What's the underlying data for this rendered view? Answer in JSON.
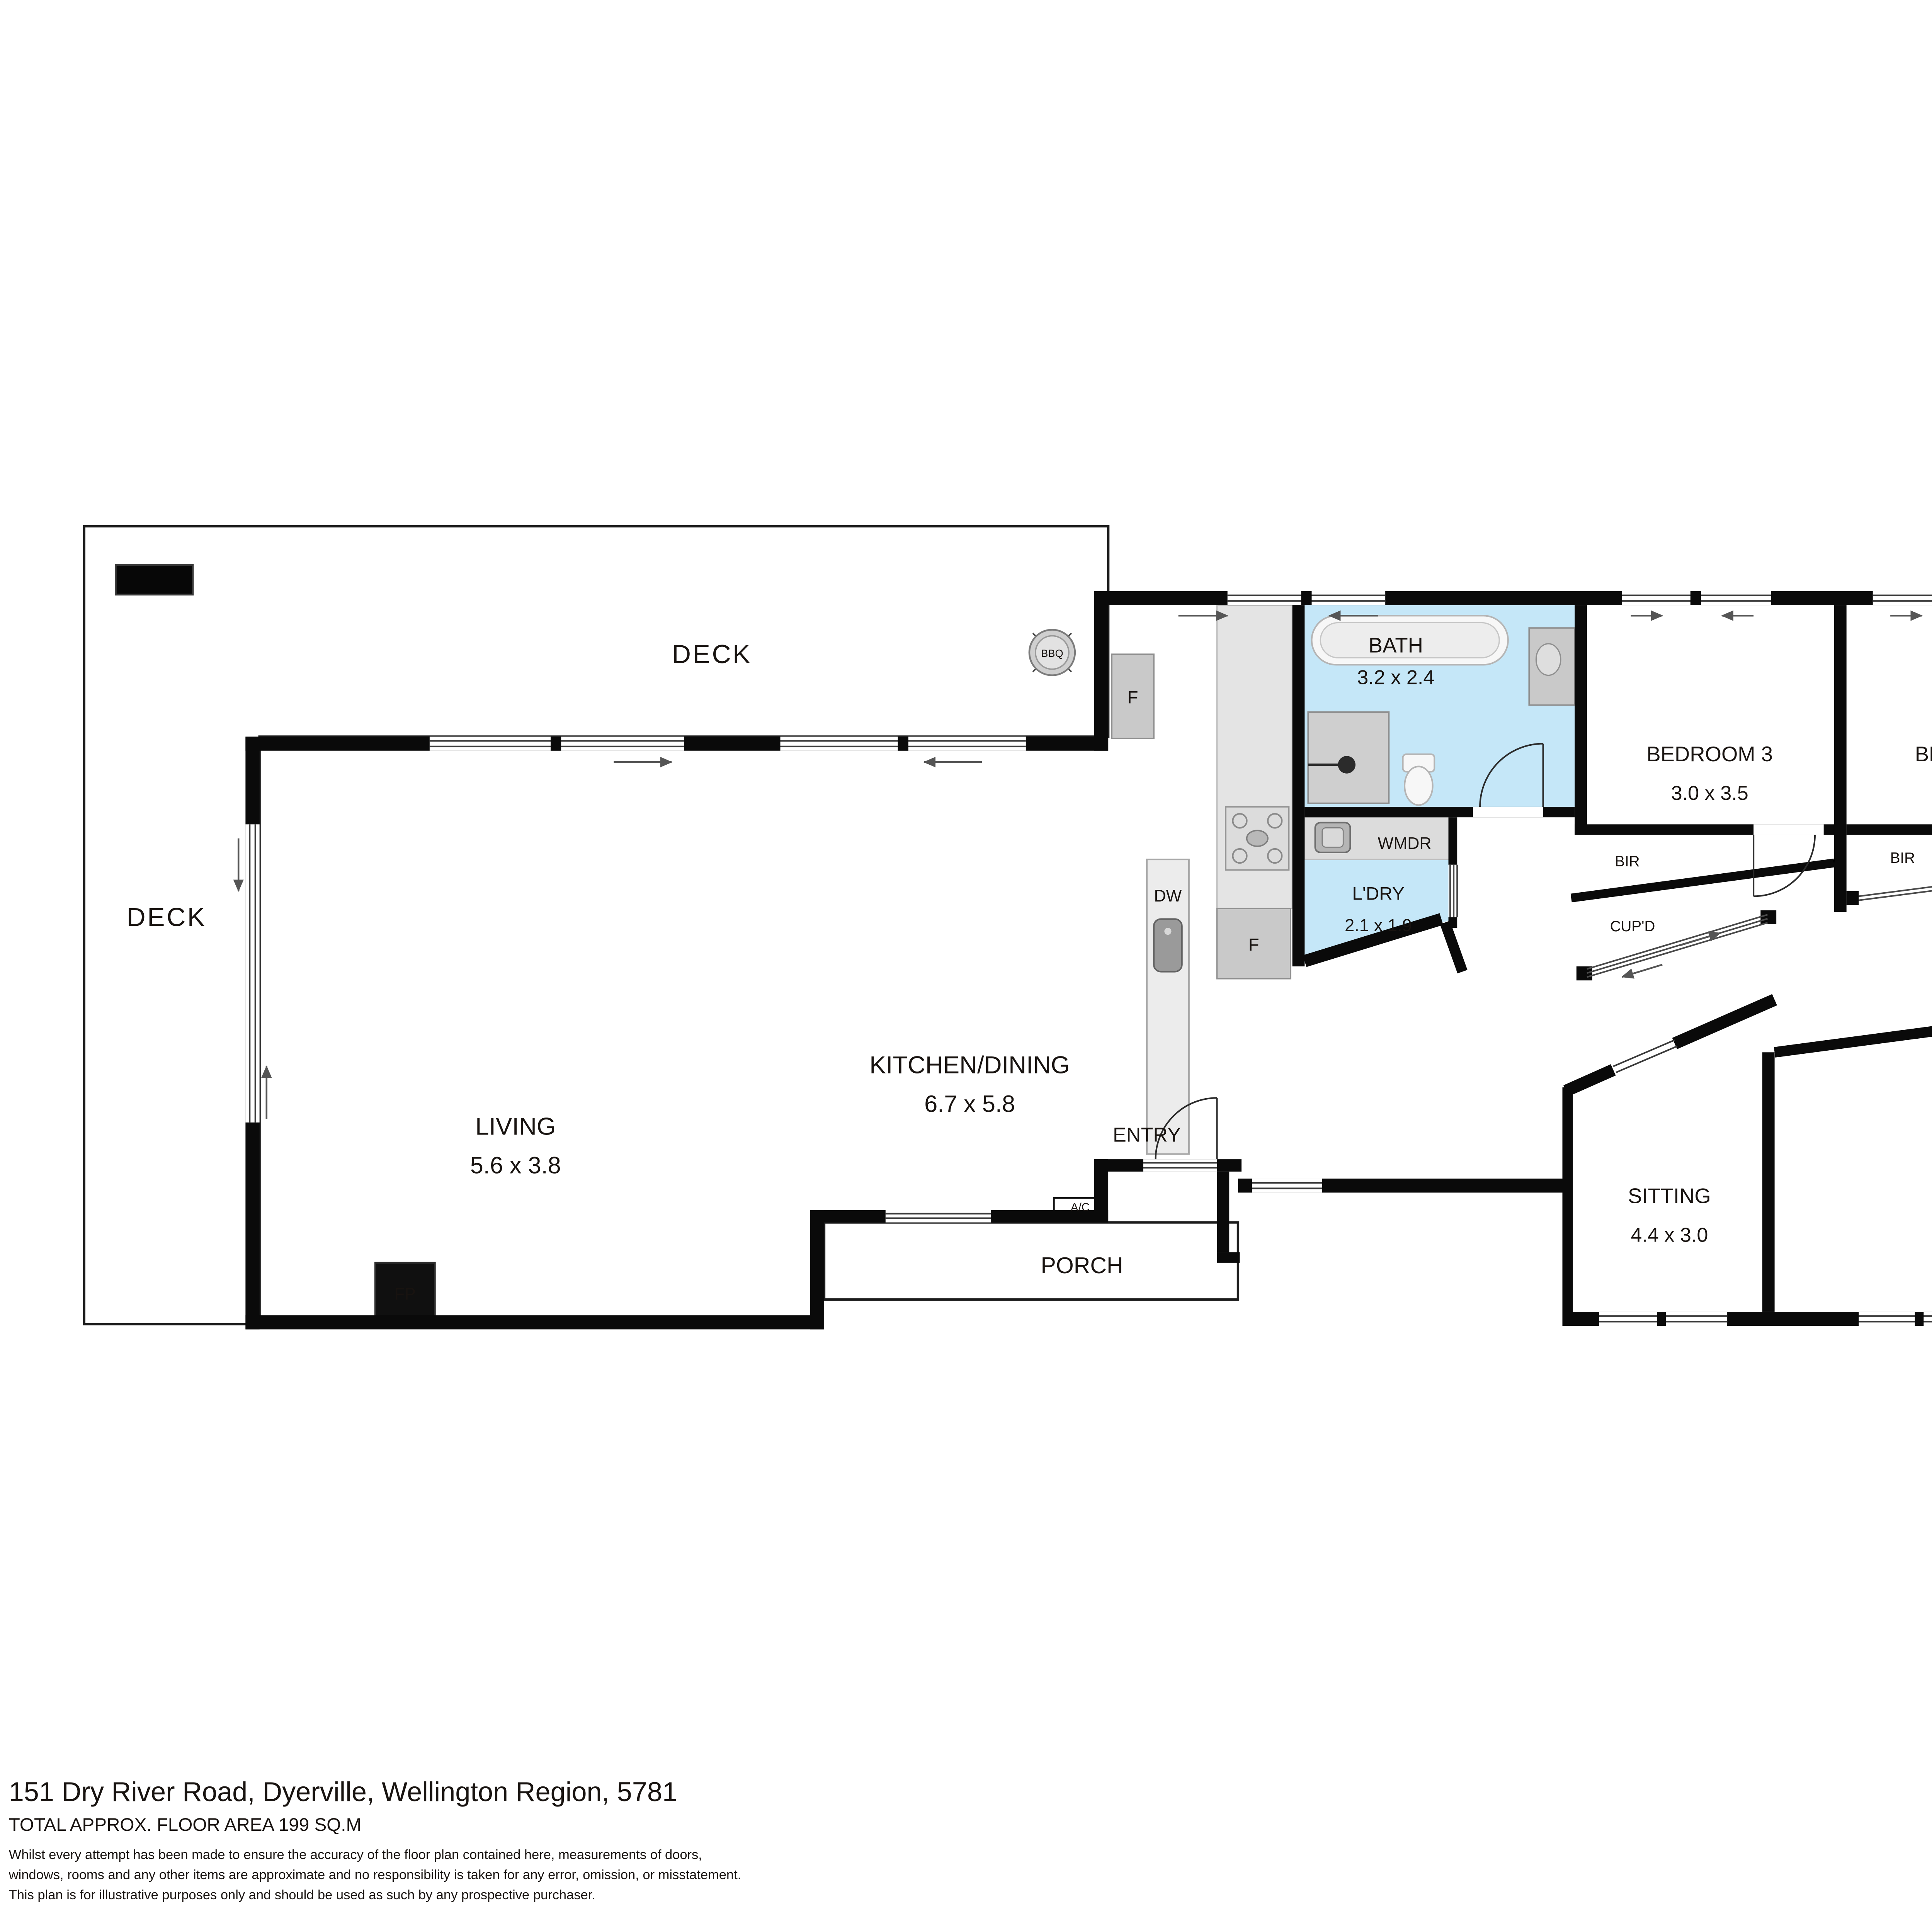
{
  "footer": {
    "address": "151 Dry River Road, Dyerville, Wellington Region, 5781",
    "floor_area": "TOTAL APPROX. FLOOR AREA 199 SQ.M",
    "disclaimer": [
      "Whilst every attempt has been made to ensure the accuracy of the floor plan contained here, measurements of doors,",
      "windows, rooms and any other items are approximate and no responsibility is taken for any error, omission, or misstatement.",
      "This plan is for illustrative purposes only and should be used as such by any prospective purchaser."
    ]
  },
  "rooms": {
    "deck_top": {
      "name": "DECK"
    },
    "deck_left": {
      "name": "DECK"
    },
    "deck_right": {
      "name": "DECK"
    },
    "kitchen_dining": {
      "name": "KITCHEN/DINING",
      "dims": "6.7 x 5.8"
    },
    "living": {
      "name": "LIVING",
      "dims": "5.6 x 3.8"
    },
    "bath": {
      "name": "BATH",
      "dims": "3.2 x 2.4"
    },
    "laundry": {
      "name": "L'DRY",
      "dims": "2.1 x 1.9"
    },
    "bedroom3": {
      "name": "BEDROOM 3",
      "dims": "3.0 x 3.5"
    },
    "bedroom4": {
      "name": "BEDROOM 4",
      "dims": "2.7 x 2.9"
    },
    "main_bedroom": {
      "line1": "MAIN",
      "line2": "BEDROOM",
      "dims": "4.2 x 3.7"
    },
    "wir": {
      "name": "WIR",
      "dims": "4.2 x 1.7"
    },
    "ens": {
      "name": "ENS",
      "dims": "4.2 x 1.6"
    },
    "bedroom2": {
      "name": "BEDROOM 2",
      "dims": "3.0 x 4.3"
    },
    "sitting": {
      "name": "SITTING",
      "dims": "4.4 x 3.0"
    },
    "entry": {
      "name": "ENTRY"
    },
    "porch": {
      "name": "PORCH"
    }
  },
  "labels": {
    "wmdr": "WMDR",
    "bir": "BIR",
    "cupd": "CUP'D",
    "dw": "DW",
    "fridge": "F",
    "fireplace": "FP",
    "ac": "A/C",
    "bbq": "BBQ"
  },
  "colors": {
    "wall": "#0a0a0a",
    "wet_area": "#c5e7f8",
    "fixture_gray": "#c9c9c9",
    "counter_gray": "#e4e4e4",
    "label_text": "#181310"
  }
}
